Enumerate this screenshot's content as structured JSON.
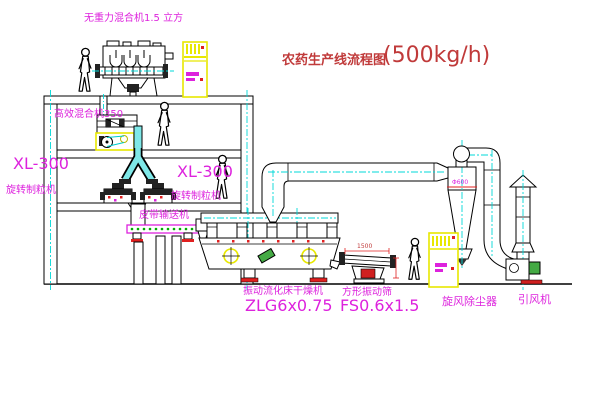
{
  "diagram": {
    "title": {
      "text": "农药生产线流程图",
      "capacity": "(500kg/h)"
    },
    "equipment_labels": {
      "zero_gravity_mixer": "无重力混合机1.5 立方",
      "high_efficiency_mixer": "高效混合机350",
      "granulator_left": {
        "model": "XL-300",
        "name": "旋转制粒机"
      },
      "granulator_right": {
        "model": "XL-300",
        "name": "旋转制粒机"
      },
      "belt_conveyor": "皮带输送机",
      "fluid_bed_dryer": {
        "name": "振动流化床干燥机",
        "model": "ZLG6x0.75"
      },
      "vibrating_screen": {
        "name": "方形振动筛",
        "model": "FS0.6x1.5"
      },
      "cyclone": "旋风除尘器",
      "induced_draft_fan": "引风机"
    },
    "dimensions": {
      "cyclone_diameter": "Φ600",
      "screen_length": "1500"
    },
    "colors": {
      "label_magenta": "#dd22dd",
      "title_red": "#c03a3a",
      "centerline_cyan": "#00d8d8",
      "equipment_yellow": "#e8e800",
      "accent_red": "#e02020",
      "motor_green": "#44aa44"
    }
  }
}
